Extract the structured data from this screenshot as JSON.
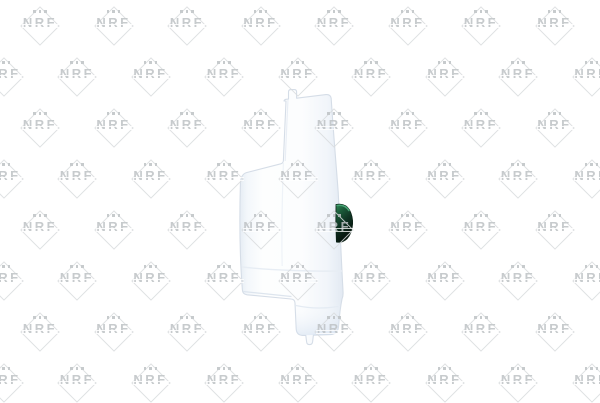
{
  "image": {
    "width": 600,
    "height": 400,
    "background_color": "#ffffff",
    "subject": "White plastic coolant expansion tank, side profile product photo"
  },
  "watermark": {
    "text": "NRF",
    "dots_count": 3,
    "text_color": "#bec2c5",
    "diamond_color": "#d9dcde",
    "rows": 8,
    "first_row_y": 25,
    "row_spacing": 51,
    "col_spacing": 73.5,
    "even_row_first_x": 40,
    "odd_row_first_x": 3.5,
    "odd_row_cols": 9,
    "even_row_cols": 8
  },
  "product": {
    "name": "expansion-tank-side-view",
    "body_color": "#fcfdfe",
    "edge_shade_color": "#e4ebf3",
    "outline_color": "#d5dde7",
    "foot_tint_color": "#dfe8f2",
    "cap": {
      "name": "sensor-cap",
      "rim_color": "#3f9c6b",
      "top_color": "#27804f",
      "dark_color": "#081510"
    }
  }
}
